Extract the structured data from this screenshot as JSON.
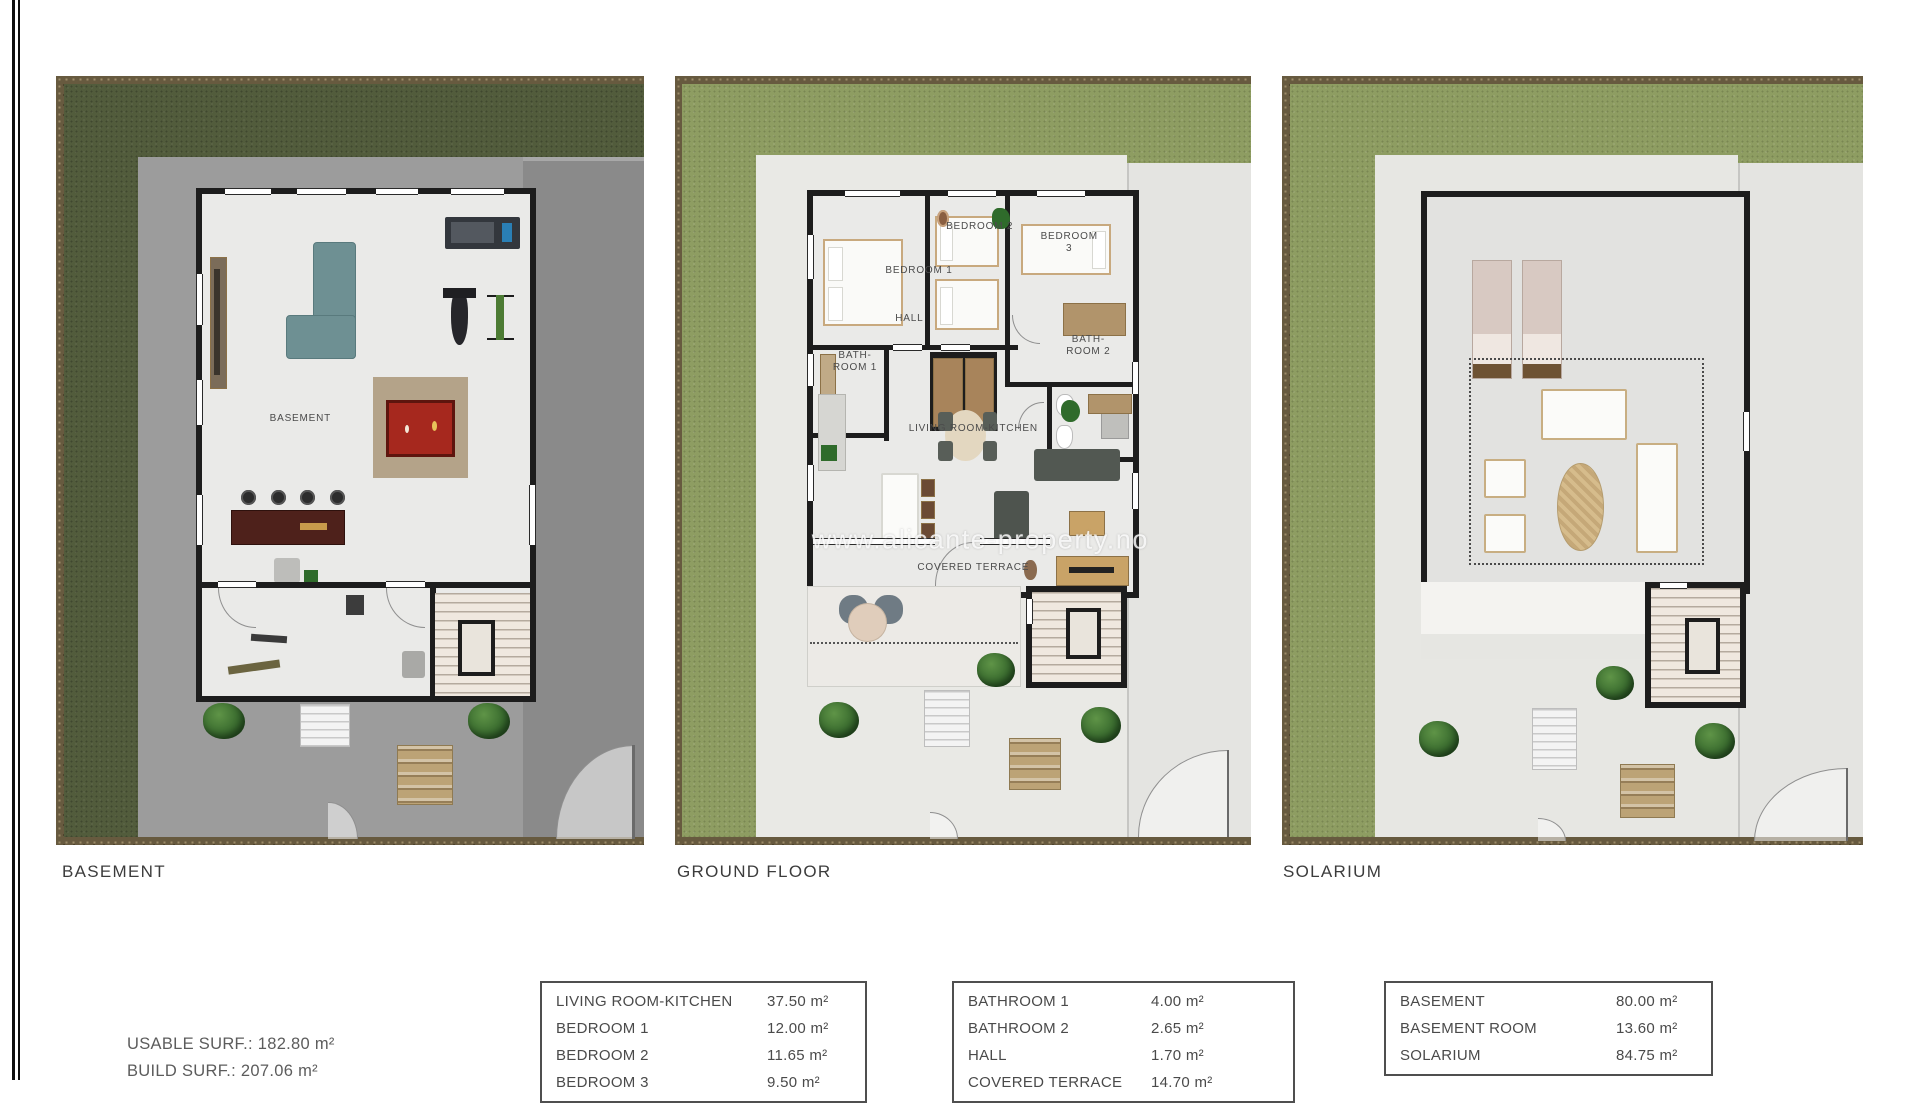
{
  "page": {
    "watermark": "www.alicante-property.no"
  },
  "plans": {
    "basement": {
      "caption": "BASEMENT",
      "room_labels": {
        "basement": "BASEMENT"
      }
    },
    "ground_floor": {
      "caption": "GROUND FLOOR",
      "room_labels": {
        "bedroom1": "BEDROOM 1",
        "bedroom2": "BEDROOM 2",
        "bedroom3": "BEDROOM 3",
        "hall": "HALL",
        "bathroom1": "BATH-\nROOM 1",
        "bathroom2": "BATH-\nROOM 2",
        "living_room_kitchen": "LIVING ROOM-KITCHEN",
        "covered_terrace": "COVERED TERRACE"
      }
    },
    "solarium": {
      "caption": "SOLARIUM",
      "room_labels": {}
    }
  },
  "summary": {
    "lines": [
      "USABLE SURF.: 182.80 m²",
      "BUILD SURF.: 207.06 m²"
    ]
  },
  "tables": [
    {
      "rows": [
        {
          "name": "LIVING ROOM-KITCHEN",
          "area": "37.50 m²"
        },
        {
          "name": "BEDROOM 1",
          "area": "12.00 m²"
        },
        {
          "name": "BEDROOM 2",
          "area": "11.65 m²"
        },
        {
          "name": "BEDROOM 3",
          "area": "9.50 m²",
          "clipped": true
        }
      ]
    },
    {
      "rows": [
        {
          "name": "BATHROOM 1",
          "area": "4.00 m²"
        },
        {
          "name": "BATHROOM 2",
          "area": "2.65 m²"
        },
        {
          "name": "HALL",
          "area": "1.70 m²"
        },
        {
          "name": "COVERED TERRACE",
          "area": "14.70 m²",
          "clipped": true
        }
      ]
    },
    {
      "rows": [
        {
          "name": "BASEMENT",
          "area": "80.00 m²"
        },
        {
          "name": "BASEMENT ROOM",
          "area": "13.60 m²"
        },
        {
          "name": "SOLARIUM",
          "area": "84.75 m²"
        }
      ]
    }
  ],
  "colors": {
    "grass_dark": "#525C3C",
    "grass_light": "#8E9D62",
    "dirt": "#675A3F",
    "wall": "#1D1D1D",
    "pool_table_red": "#A6281E",
    "sofa_teal": "#6E9093",
    "concrete": "#9C9C9C",
    "pavement_light": "#E9E9E5"
  }
}
